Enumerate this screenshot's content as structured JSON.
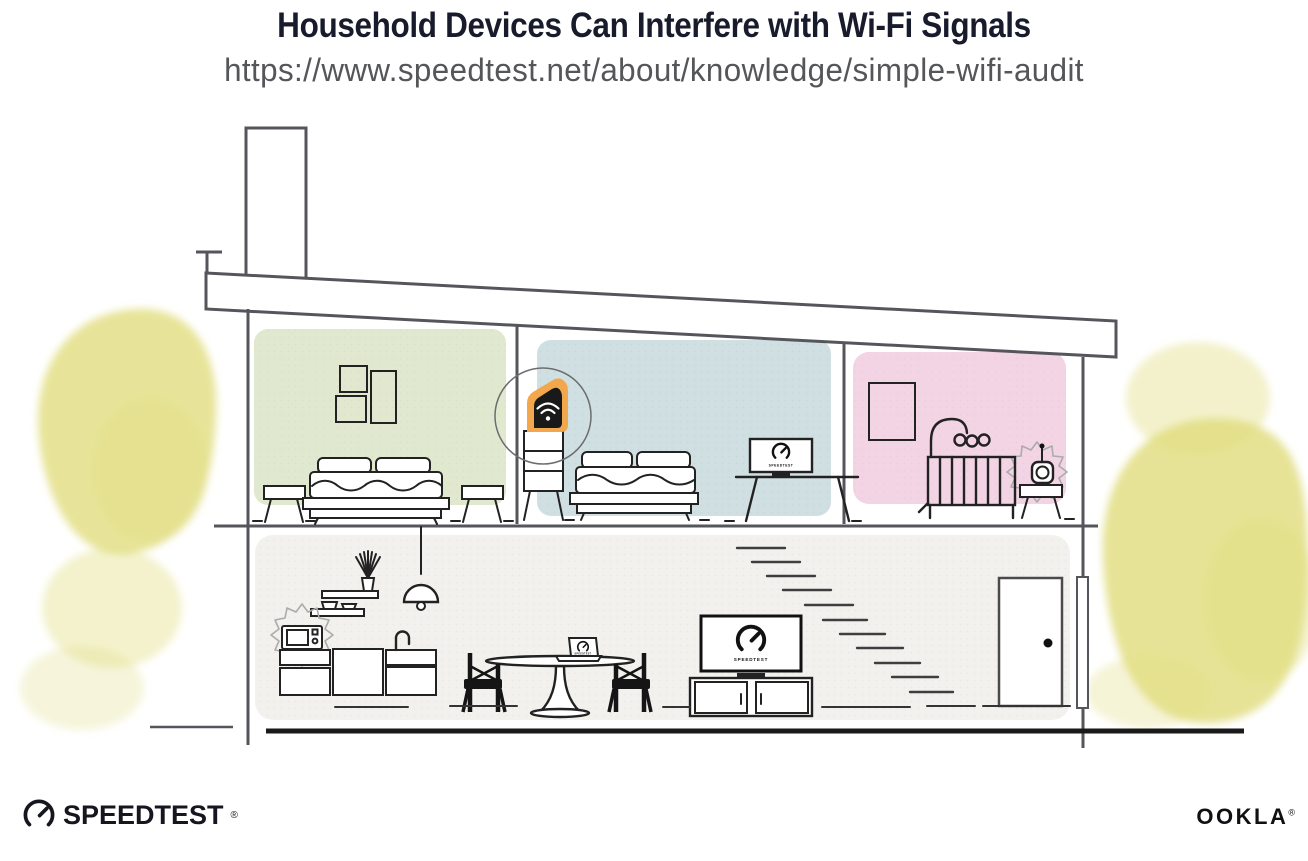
{
  "header": {
    "title": "Household Devices Can Interfere with Wi-Fi Signals",
    "url": "https://www.speedtest.net/about/knowledge/simple-wifi-audit"
  },
  "device_screens": {
    "bedroom_tv_label": "SPEEDTEST",
    "living_tv_label": "SPEEDTEST",
    "laptop_label": "SPEEDTEST"
  },
  "branding": {
    "speedtest_wordmark": "SPEEDTEST",
    "speedtest_reg_mark": "®",
    "ookla_wordmark": "OOKLA",
    "ookla_reg_mark": "®"
  },
  "palette": {
    "title_color": "#181b2b",
    "url_color": "#55565a",
    "structure_line": "#55565b",
    "bedroom_left_wall": "#e0e9cf",
    "bedroom_middle_wall": "#cfdfe2",
    "nursery_wall": "#f3d4e4",
    "main_floor_wall": "#f2f1ee",
    "router_highlight": "#f2a74d",
    "foliage": "#e0dc7c",
    "ink": "#191919"
  },
  "illustration": {
    "rooms": [
      "bedroom-left",
      "bedroom-middle",
      "nursery",
      "main-floor"
    ],
    "wifi_device": "wifi-router",
    "interference_sources": [
      "microwave-oven",
      "baby-monitor"
    ]
  }
}
